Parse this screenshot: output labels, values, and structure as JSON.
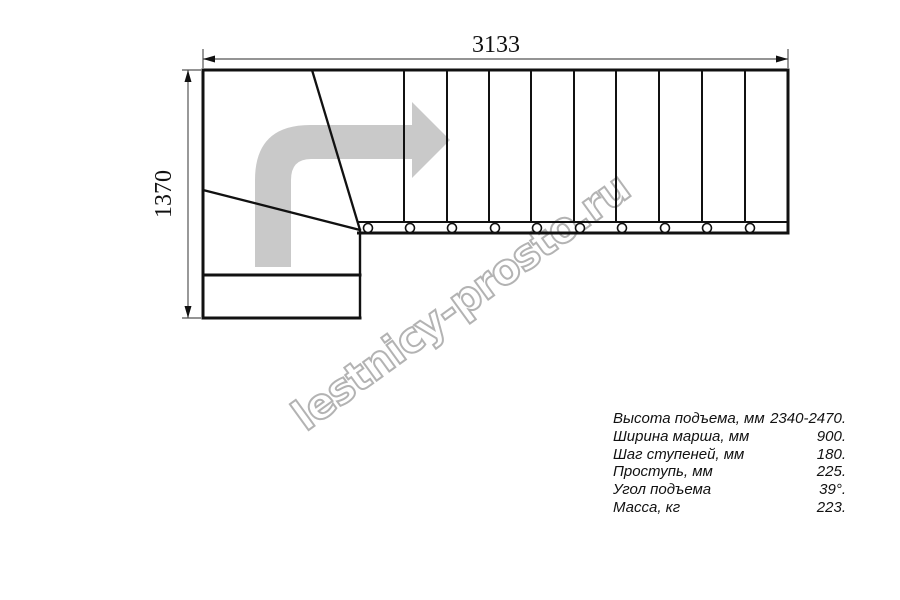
{
  "drawing": {
    "dim_width_label": "3133",
    "dim_height_label": "1370",
    "flight_top": 70,
    "band_top": 222,
    "riser_xs": [
      404,
      447,
      489,
      531,
      574,
      616,
      659,
      702,
      745
    ],
    "baluster_xs": [
      368,
      410,
      452,
      495,
      537,
      580,
      622,
      665,
      707,
      750
    ],
    "baluster_cy": 228,
    "baluster_r": 4.5
  },
  "colors": {
    "line": "#111111",
    "dim_line": "#555555",
    "arrow_gray": "#c9c9c9",
    "watermark_gray": "#b3b3b3",
    "background": "#ffffff"
  },
  "watermark": {
    "text": "lestnicy-prosto.ru"
  },
  "specs": {
    "rows": [
      {
        "label": "Высота подъема, мм",
        "value": "2340-2470."
      },
      {
        "label": "Ширина марша, мм",
        "value": "900."
      },
      {
        "label": "Шаг ступеней, мм",
        "value": "180."
      },
      {
        "label": "Проступь, мм",
        "value": "225."
      },
      {
        "label": "Угол подъема",
        "value": "39°."
      },
      {
        "label": "Масса, кг",
        "value": "223."
      }
    ]
  }
}
